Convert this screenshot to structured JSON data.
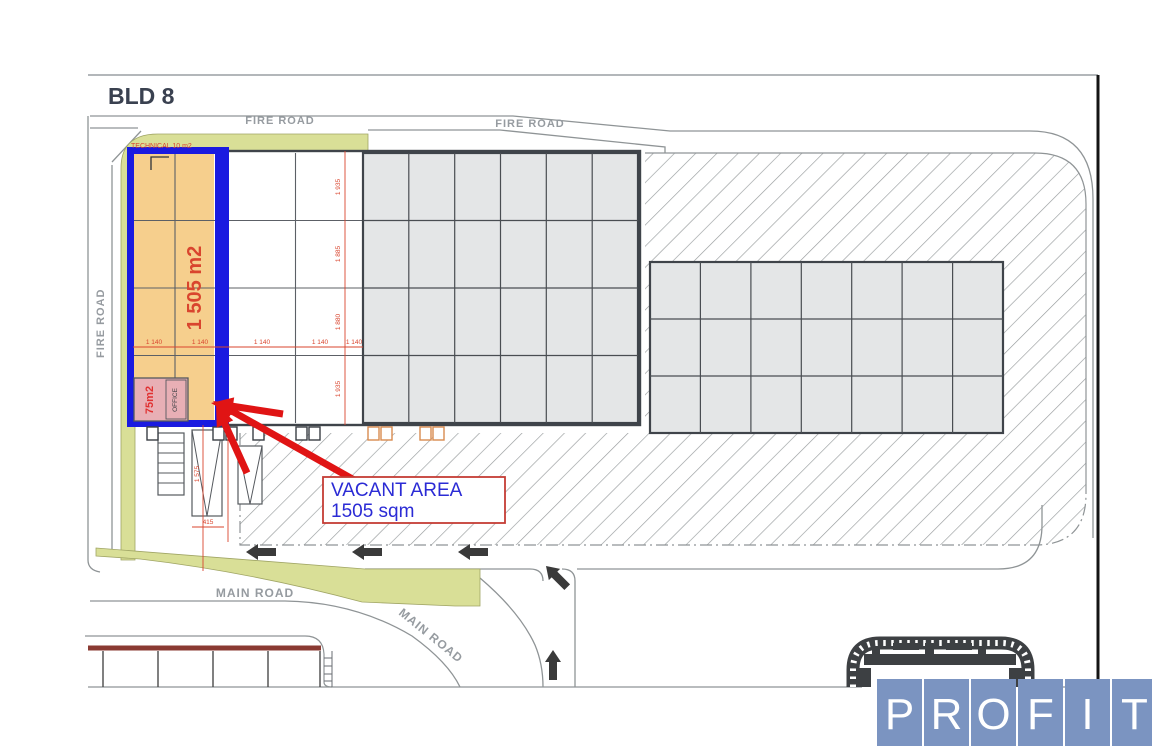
{
  "page": {
    "title": "BLD 8"
  },
  "roads": {
    "fire_road_top_left": "FIRE ROAD",
    "fire_road_top_right": "FIRE ROAD",
    "fire_road_left": "FIRE ROAD",
    "main_road": "MAIN ROAD",
    "main_road_diagonal": "MAIN ROAD"
  },
  "vacant_area": {
    "size_label": "1 505 m2",
    "technical_label": "TECHNICAL 10 m2",
    "office": {
      "size": "75m2",
      "label": "OFFICE"
    },
    "callout_title": "VACANT AREA",
    "callout_size": "1505 sqm"
  },
  "dimensions": {
    "column_widths": [
      "1 140",
      "1 140",
      "1 140",
      "1 140",
      "1 140"
    ],
    "row_heights": [
      "1 935",
      "1 885",
      "1 880",
      "1 935"
    ],
    "ramp": [
      "1 575",
      "415"
    ]
  },
  "logo": {
    "letters": [
      "P",
      "R",
      "O",
      "F",
      "I",
      "T"
    ]
  },
  "colors": {
    "vacant_fill": "#F6CF8D",
    "vacant_border_blue": "#1A1AE0",
    "office_pink": "#E8AFB5",
    "dimension_red": "#D9452E",
    "arrow_red": "#E01414",
    "callout_border": "#C43C35",
    "callout_text": "#2B2BD5",
    "green_verge": "#D9DF97",
    "parking_gray": "#E4E6E7",
    "road_gray": "#8F9496",
    "label_gray": "#969BA0",
    "logo_blue": "#7B94C1",
    "dark_outline": "#3F444A",
    "building_red_line": "#8A3A32"
  }
}
